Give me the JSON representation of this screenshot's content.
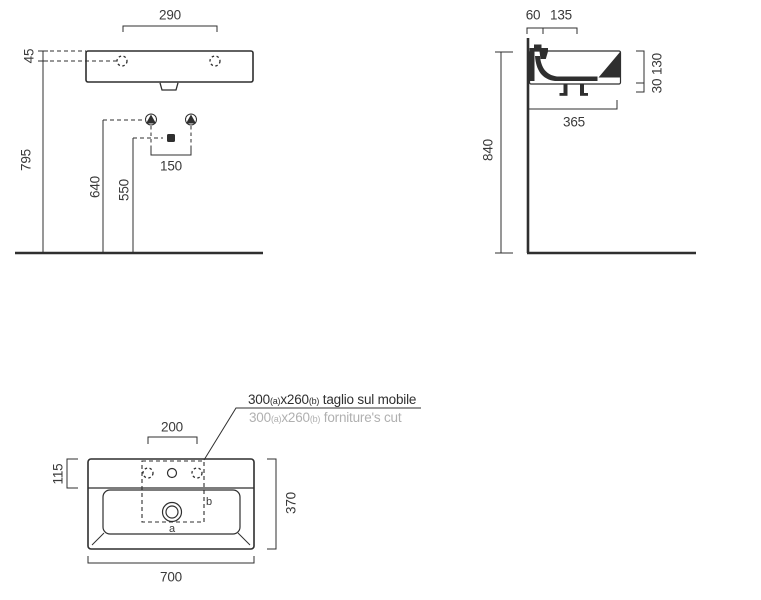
{
  "drawing_title": "wall-hung washbasin installation drawing",
  "front_view": {
    "tap_holes_spacing": "290",
    "rim_thickness": "45",
    "wall_drain_height": "795",
    "supply_height": "640",
    "waste_height": "550",
    "supply_spacing": "150"
  },
  "side_view": {
    "wall_to_tap": "60",
    "tap_zone_depth": "135",
    "basin_height": "130",
    "drain_stub": "30",
    "rim_height_from_floor": "840",
    "basin_depth": "365"
  },
  "top_view": {
    "tap_holes_spacing": "200",
    "back_deck_depth": "115",
    "overall_depth": "370",
    "overall_width": "700",
    "cut_label_a": "a",
    "cut_label_b": "b",
    "note_it": {
      "val": "300",
      "a": "(a)",
      "x": "x260",
      "b": "(b)",
      "text": " taglio sul mobile"
    },
    "note_en": {
      "val": "300",
      "a": "(a)",
      "x": "x260",
      "b": "(b)",
      "text": " forniture's cut"
    }
  },
  "colors": {
    "line": "#2f2f2f",
    "text": "#3a3a3a",
    "muted_text": "#b0b0b0"
  }
}
